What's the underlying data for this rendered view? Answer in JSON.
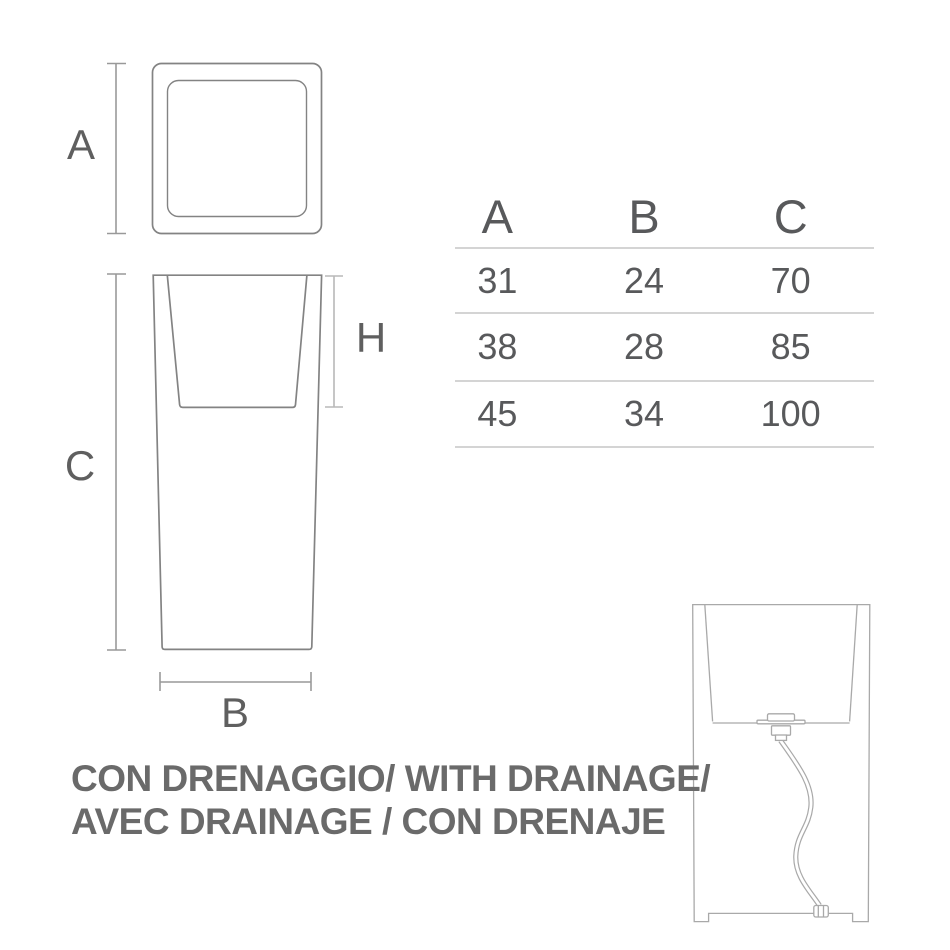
{
  "dimension_labels": {
    "a": "A",
    "b": "B",
    "c": "C",
    "h": "H"
  },
  "size_table": {
    "headers": [
      "A",
      "B",
      "C"
    ],
    "rows": [
      [
        "31",
        "24",
        "70"
      ],
      [
        "38",
        "28",
        "85"
      ],
      [
        "45",
        "34",
        "100"
      ]
    ]
  },
  "caption": {
    "line1": "CON DRENAGGIO/ WITH DRAINAGE/",
    "line2": "AVEC DRAINAGE / CON DRENAJE"
  },
  "colors": {
    "outline": "#838383",
    "detail_outline": "#a9a9a9",
    "dimension_line": "#999999",
    "dimension_line_light": "#b8b8b8",
    "label_text": "#5f5f5f",
    "table_text": "#58595b",
    "table_rule": "#d4d4d4",
    "caption_text": "#6a6a6a",
    "background": "#ffffff"
  }
}
